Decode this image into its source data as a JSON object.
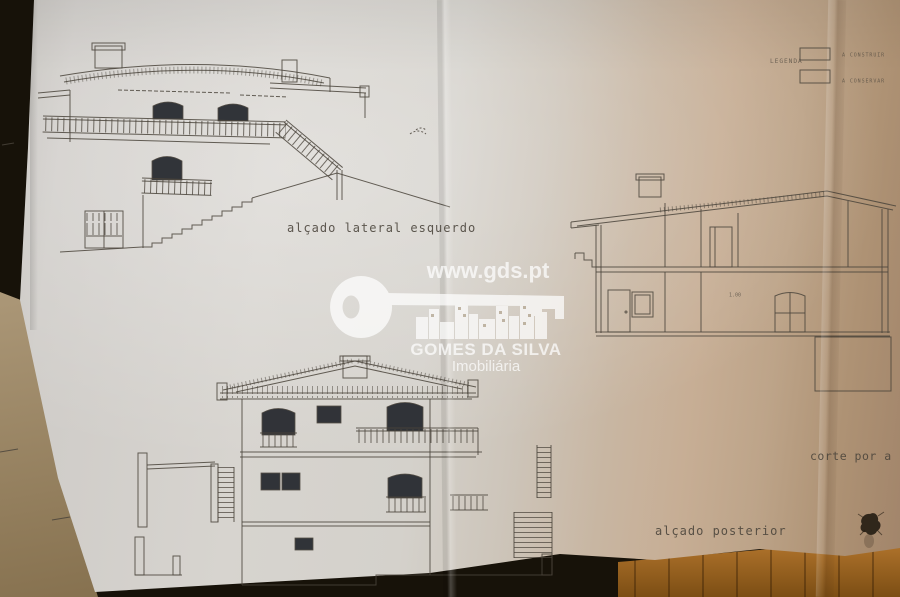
{
  "labels": {
    "left_elevation": "alçado lateral esquerdo",
    "section": "corte por a b",
    "rear_elevation": "alçado posterior",
    "section_dimension": "1.00"
  },
  "legend": {
    "title": "LEGENDA",
    "items": [
      {
        "label": "A CONSTRUIR"
      },
      {
        "label": "A CONSERVAR"
      }
    ]
  },
  "watermark": {
    "url": "www.gds.pt",
    "key_text": "GDS",
    "company": "GOMES DA SILVA",
    "tagline": "Imobiliária"
  },
  "colors": {
    "paper_light": "#d7d4cf",
    "paper_tan": "#c7ae95",
    "paper_tan_dark": "#a1846a",
    "ink": "#4a443b",
    "window": "#23262c",
    "backdrop": "#171209",
    "wood": "#b5772e",
    "wood_dark": "#7c4e14",
    "table": "#ac9878",
    "watermark": "#ffffff"
  }
}
